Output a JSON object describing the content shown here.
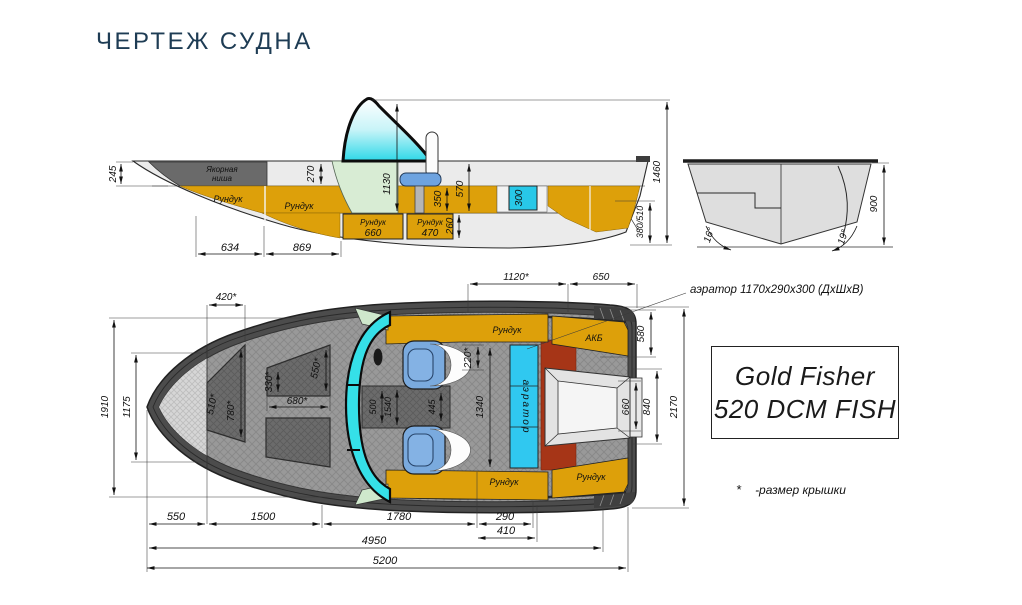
{
  "page": {
    "title": "ЧЕРТЕЖ СУДНА"
  },
  "colors": {
    "title_navy": "#1e3c54",
    "locker_orange": "#dda00a",
    "aerator_cyan": "#2cc8ec",
    "windshield_cyan": "#2ed8e8",
    "maroon": "#a63517",
    "seat_blue": "#7aaade"
  },
  "side_view": {
    "anchor_niche": {
      "line1": "Якорная",
      "line2": "ниша"
    },
    "lockers": {
      "l1": "Рундук",
      "l2": "Рундук",
      "l3_name": "Рундук",
      "l3_size": "660",
      "l4_name": "Рундук",
      "l4_size": "470"
    },
    "dims": {
      "d245": "245",
      "d270": "270",
      "d1130": "1130",
      "d350": "350",
      "d570": "570",
      "d300": "300",
      "d260": "260",
      "d634": "634",
      "d869": "869",
      "d1460": "1460",
      "d380_510": "380/510"
    }
  },
  "transom_view": {
    "dims": {
      "d900": "900",
      "angle_left": "16°",
      "angle_right": "19°"
    }
  },
  "top_view": {
    "labels": {
      "locker_top": "Рундук",
      "locker_bottom": "Рундук",
      "locker_stern": "Рундук",
      "battery": "АКБ",
      "aerator": "аэратор"
    },
    "dims": {
      "d420": "420*",
      "d510": "510*",
      "d780": "780*",
      "d330": "330*",
      "d550_lid": "550*",
      "d680": "680*",
      "d1120": "1120*",
      "d650": "650",
      "d580": "580",
      "d220": "220*",
      "d500": "500",
      "d1540": "1540",
      "d445": "445",
      "d1340": "1340",
      "d1910": "1910",
      "d1175": "1175",
      "d660": "660",
      "d840": "840",
      "d2170": "2170",
      "d550": "550",
      "d1500": "1500",
      "d1780": "1780",
      "d290": "290",
      "d410": "410",
      "d4950": "4950",
      "d5200": "5200"
    }
  },
  "callout": {
    "aerator_note": "аэратор 1170х290х300 (ДхШхВ)"
  },
  "model_plate": {
    "line1": "Gold Fisher",
    "line2": "520 DCM FISH"
  },
  "footnote": {
    "marker": "*",
    "text": "-размер крышки"
  }
}
